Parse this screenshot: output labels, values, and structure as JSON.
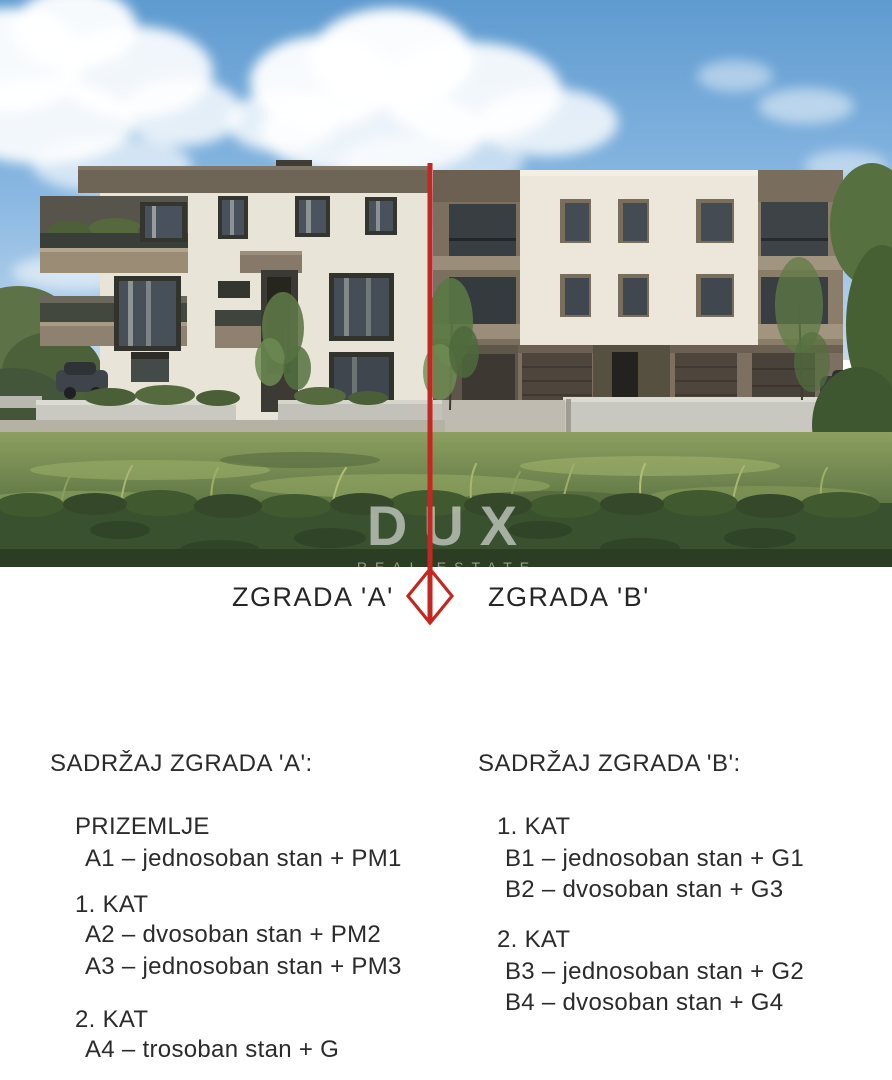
{
  "photo": {
    "watermark": {
      "brand": "DUX",
      "tagline": "REAL ESTATE"
    },
    "labels": {
      "a": "ZGRADA 'A'",
      "b": "ZGRADA 'B'"
    }
  },
  "sections": {
    "a": {
      "title": "SADRŽAJ ZGRADA 'A':",
      "groups": [
        {
          "heading": "PRIZEMLJE",
          "items": [
            "A1 – jednosoban stan + PM1"
          ]
        },
        {
          "heading": "1. KAT",
          "items": [
            "A2 – dvosoban stan + PM2",
            "A3 – jednosoban stan + PM3"
          ]
        },
        {
          "heading": "2. KAT",
          "items": [
            "A4 – trosoban stan + G"
          ]
        }
      ]
    },
    "b": {
      "title": "SADRŽAJ ZGRADA 'B':",
      "groups": [
        {
          "heading": "1. KAT",
          "items": [
            "B1 – jednosoban stan + G1",
            "B2 – dvosoban stan + G3"
          ]
        },
        {
          "heading": "2. KAT",
          "items": [
            "B3 – jednosoban stan + G2",
            "B4 – dvosoban stan + G4"
          ]
        }
      ]
    }
  },
  "colors": {
    "divider_red": "#c4271f",
    "facade_cream": "#ece7da",
    "roof_taupe": "#6f6557",
    "text": "#2b2b2b",
    "sky_top": "#5f9bd0",
    "grass": "#6f854e",
    "hedge": "#3a5130"
  }
}
